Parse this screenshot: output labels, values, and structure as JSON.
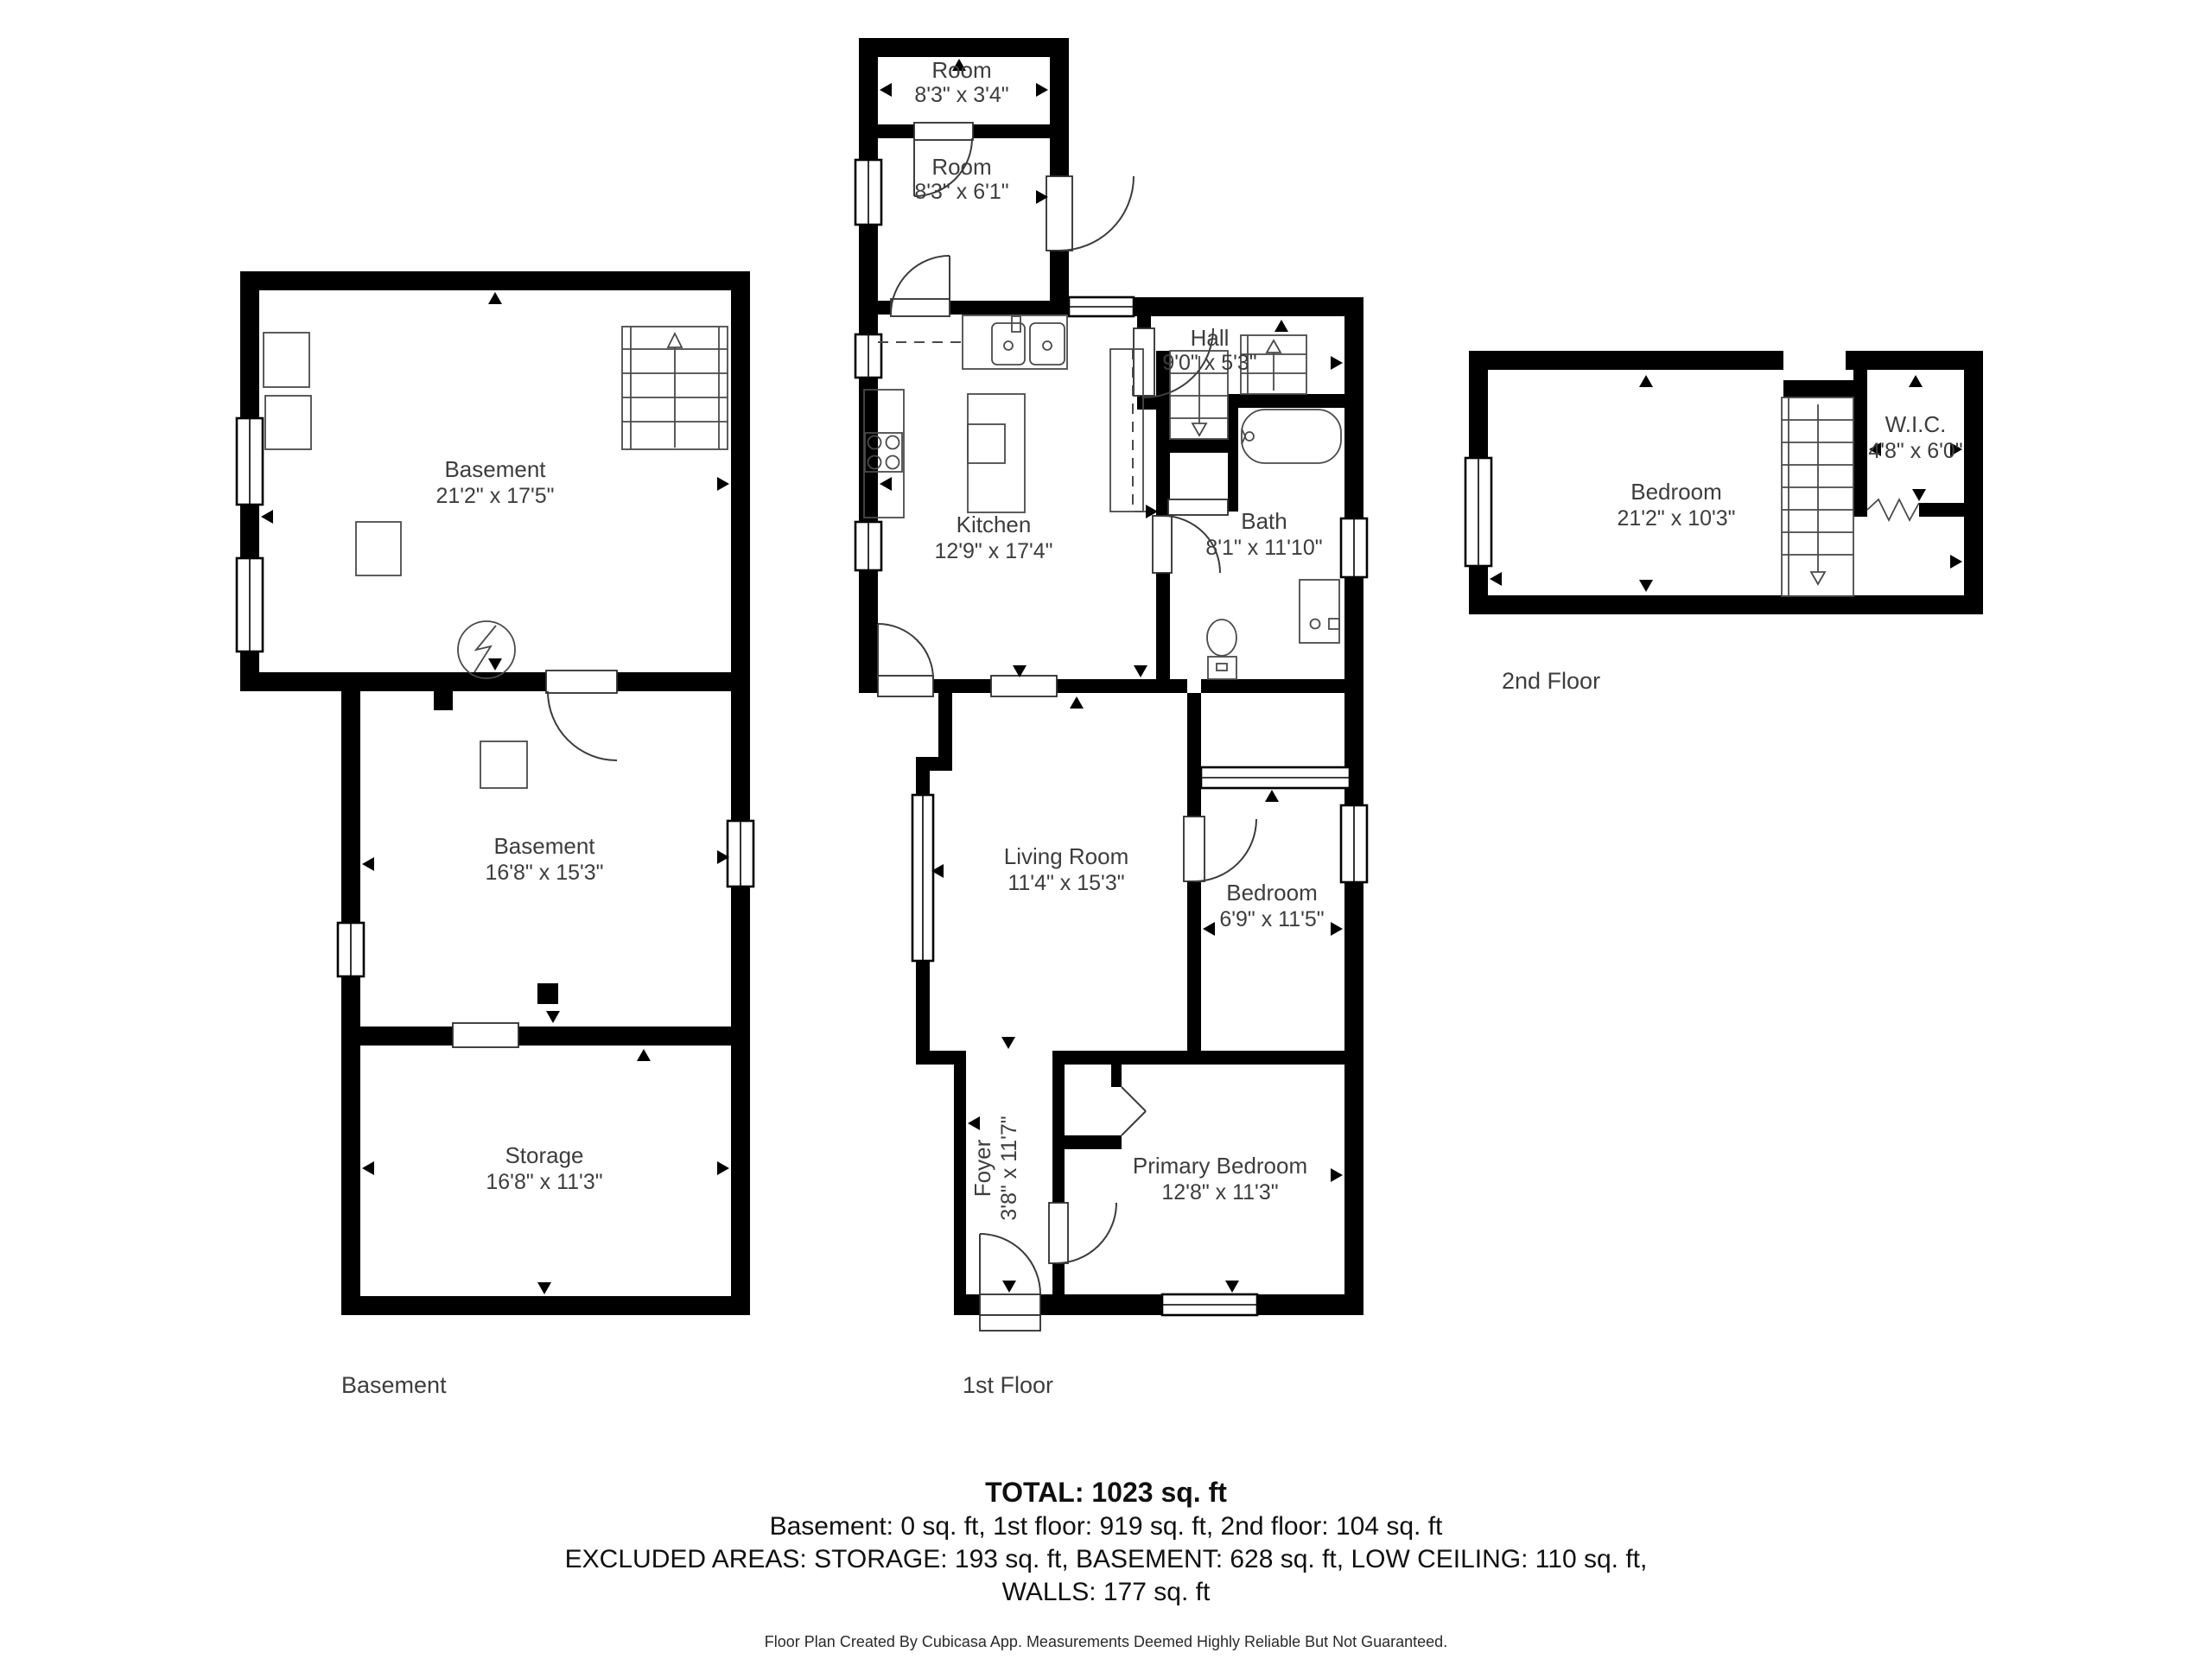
{
  "colors": {
    "wall": "#000000",
    "label_text": "#3d3d3d",
    "fixture_stroke": "#4a4a4a",
    "summary_text": "#101010",
    "background": "#ffffff"
  },
  "floors": {
    "basement": {
      "label": "Basement",
      "rooms": {
        "basement_upper": {
          "name": "Basement",
          "dims": "21'2\" x 17'5\""
        },
        "basement_lower": {
          "name": "Basement",
          "dims": "16'8\" x 15'3\""
        },
        "storage": {
          "name": "Storage",
          "dims": "16'8\" x 11'3\""
        }
      }
    },
    "first": {
      "label": "1st Floor",
      "rooms": {
        "room_top": {
          "name": "Room",
          "dims": "8'3\" x 3'4\""
        },
        "room_mid": {
          "name": "Room",
          "dims": "8'3\" x 6'1\""
        },
        "hall": {
          "name": "Hall",
          "dims": "9'0\" x 5'3\""
        },
        "kitchen": {
          "name": "Kitchen",
          "dims": "12'9\" x 17'4\""
        },
        "bath": {
          "name": "Bath",
          "dims": "8'1\" x 11'10\""
        },
        "living_room": {
          "name": "Living Room",
          "dims": "11'4\" x 15'3\""
        },
        "bedroom": {
          "name": "Bedroom",
          "dims": "6'9\" x 11'5\""
        },
        "foyer": {
          "name": "Foyer",
          "dims": "3'8\" x 11'7\""
        },
        "primary_bedroom": {
          "name": "Primary Bedroom",
          "dims": "12'8\" x 11'3\""
        }
      }
    },
    "second": {
      "label": "2nd Floor",
      "rooms": {
        "bedroom": {
          "name": "Bedroom",
          "dims": "21'2\" x 10'3\""
        },
        "wic": {
          "name": "W.I.C.",
          "dims": "4'8\" x 6'0\""
        }
      }
    }
  },
  "summary": {
    "total": "TOTAL: 1023 sq. ft",
    "floors_line": "Basement: 0 sq. ft, 1st floor: 919 sq. ft, 2nd floor: 104 sq. ft",
    "excluded_line": "EXCLUDED AREAS: STORAGE: 193 sq. ft, BASEMENT: 628 sq. ft, LOW CEILING: 110 sq. ft,",
    "walls_line": "WALLS: 177 sq. ft"
  },
  "footer": "Floor Plan Created By Cubicasa App. Measurements Deemed Highly Reliable But Not Guaranteed."
}
